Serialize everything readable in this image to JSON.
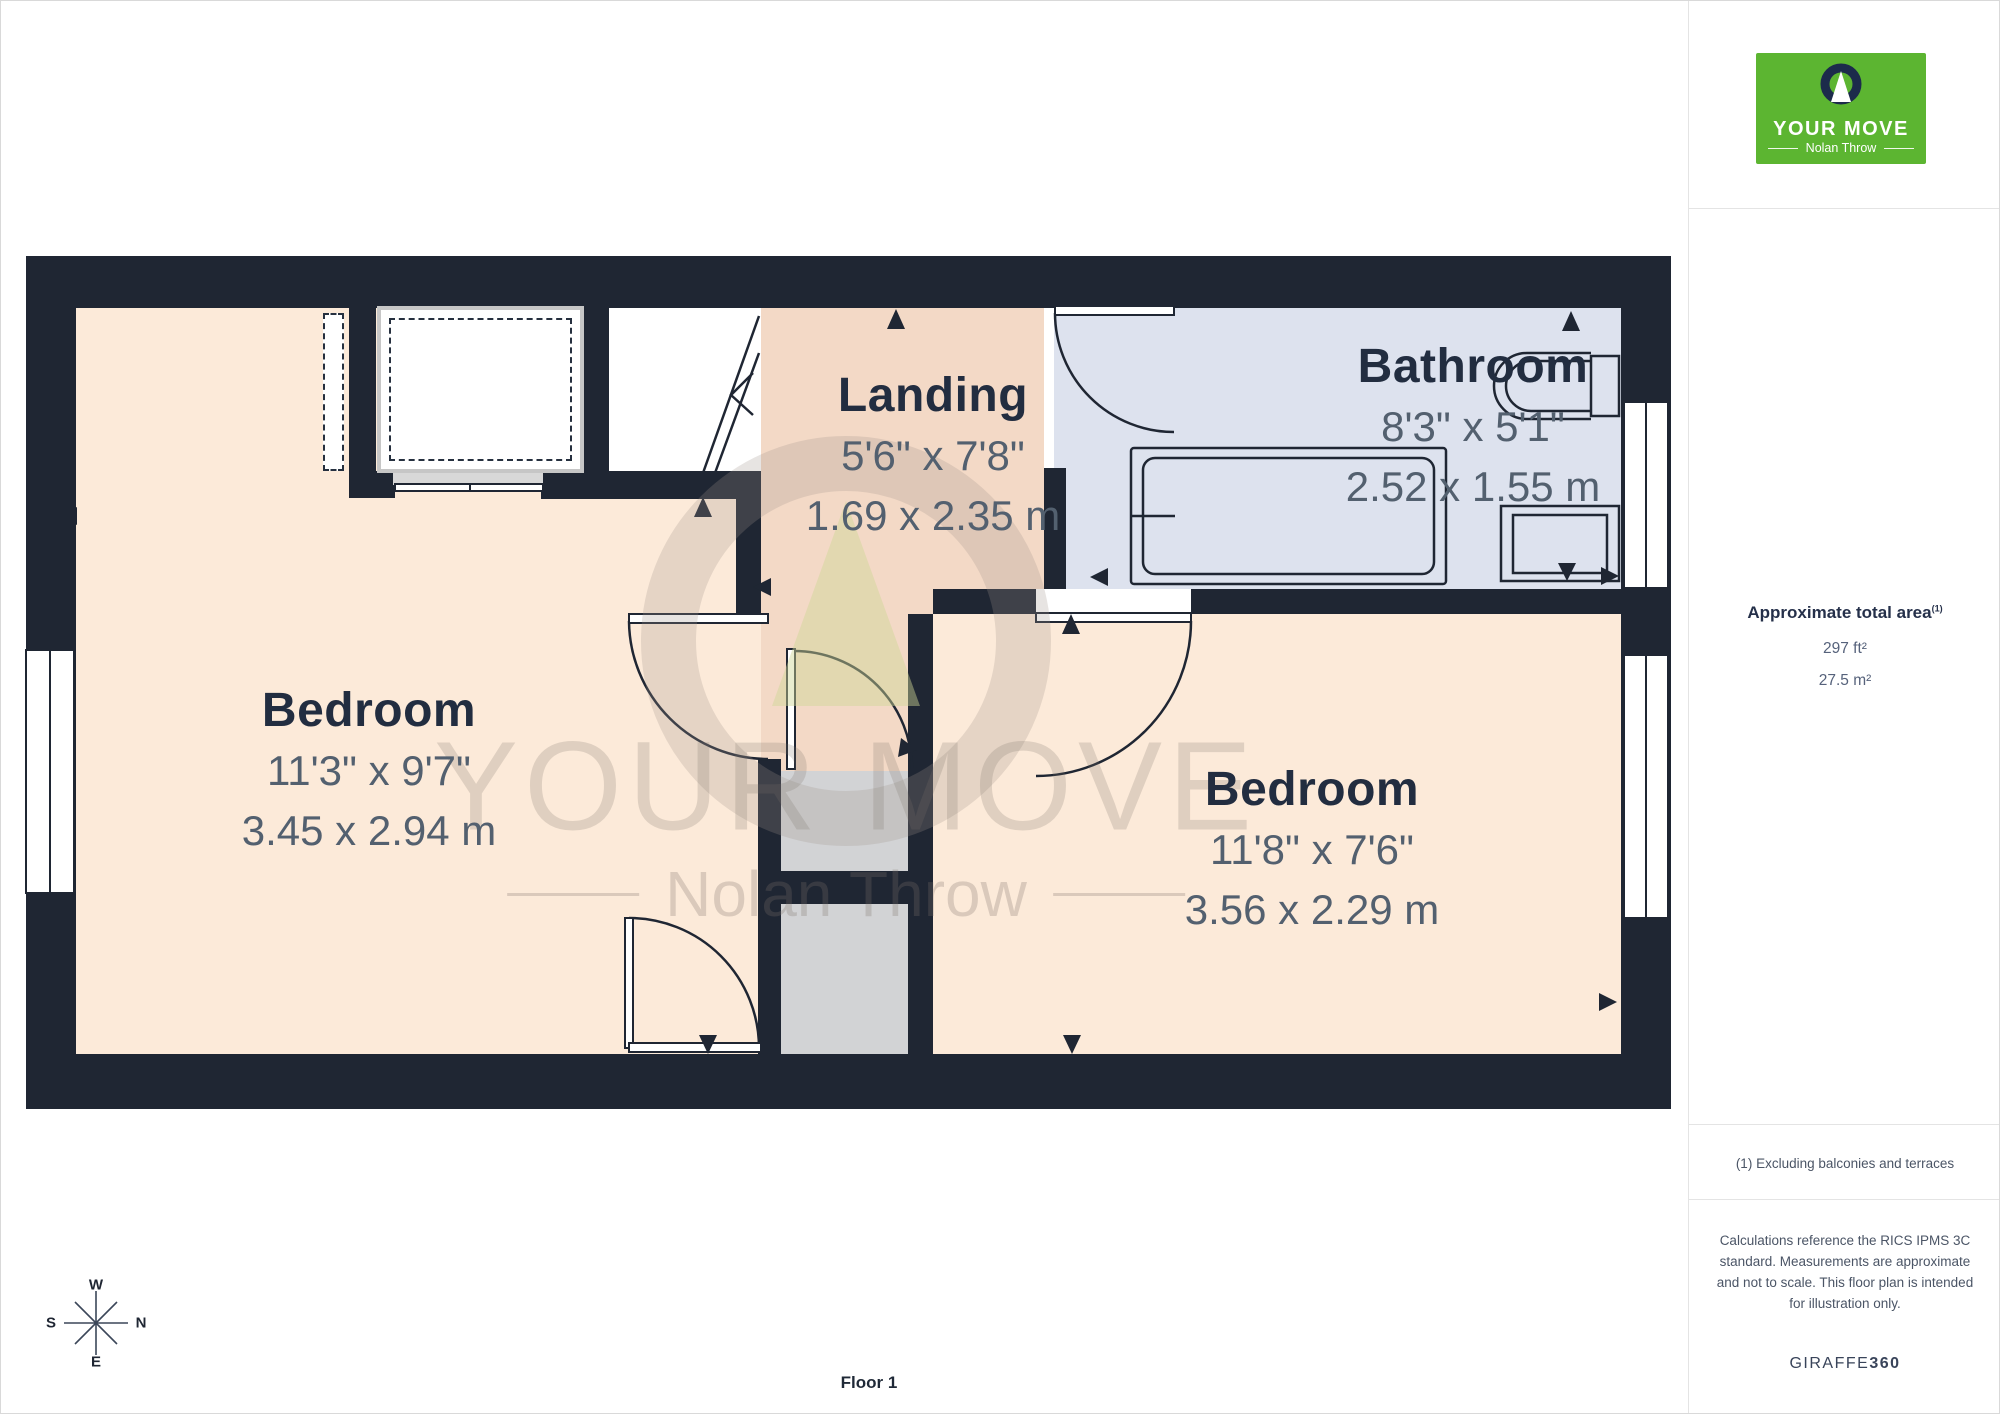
{
  "plan": {
    "floor_label": "Floor 1",
    "rooms": [
      {
        "name": "Bedroom",
        "imperial": "11'3\" x 9'7\"",
        "metric": "3.45 x 2.94 m"
      },
      {
        "name": "Landing",
        "imperial": "5'6\" x 7'8\"",
        "metric": "1.69 x 2.35 m"
      },
      {
        "name": "Bathroom",
        "imperial": "8'3\" x 5'1\"",
        "metric": "2.52 x 1.55 m"
      },
      {
        "name": "Bedroom",
        "imperial": "11'8\" x 7'6\"",
        "metric": "3.56 x 2.29 m"
      }
    ],
    "compass": {
      "n": "N",
      "s": "S",
      "e": "E",
      "w": "W"
    }
  },
  "watermark": {
    "title": "YOUR MOVE",
    "subtitle": "Nolan Throw"
  },
  "sidebar": {
    "logo": {
      "line1": "YOUR MOVE",
      "line2": "Nolan Throw"
    },
    "area": {
      "title": "Approximate total area",
      "superscript": "(1)",
      "imperial": "297 ft²",
      "metric": "27.5 m²"
    },
    "footnote": "(1) Excluding balconies and terraces",
    "disclaimer": "Calculations reference the RICS IPMS 3C standard. Measurements are approximate and not to scale. This floor plan is intended for illustration only.",
    "brand": {
      "name": "GIRAFFE",
      "suffix": "360"
    }
  },
  "colors": {
    "wall": "#1f2633",
    "bedroom_fill": "#fcead9",
    "landing_fill": "#f3d9c6",
    "bathroom_fill": "#dde2ee",
    "void_fill": "#d2d3d5",
    "logo_green": "#5cb531",
    "logo_navy": "#1c2b4b",
    "dim_text": "#53606f",
    "title_text": "#222d40"
  }
}
